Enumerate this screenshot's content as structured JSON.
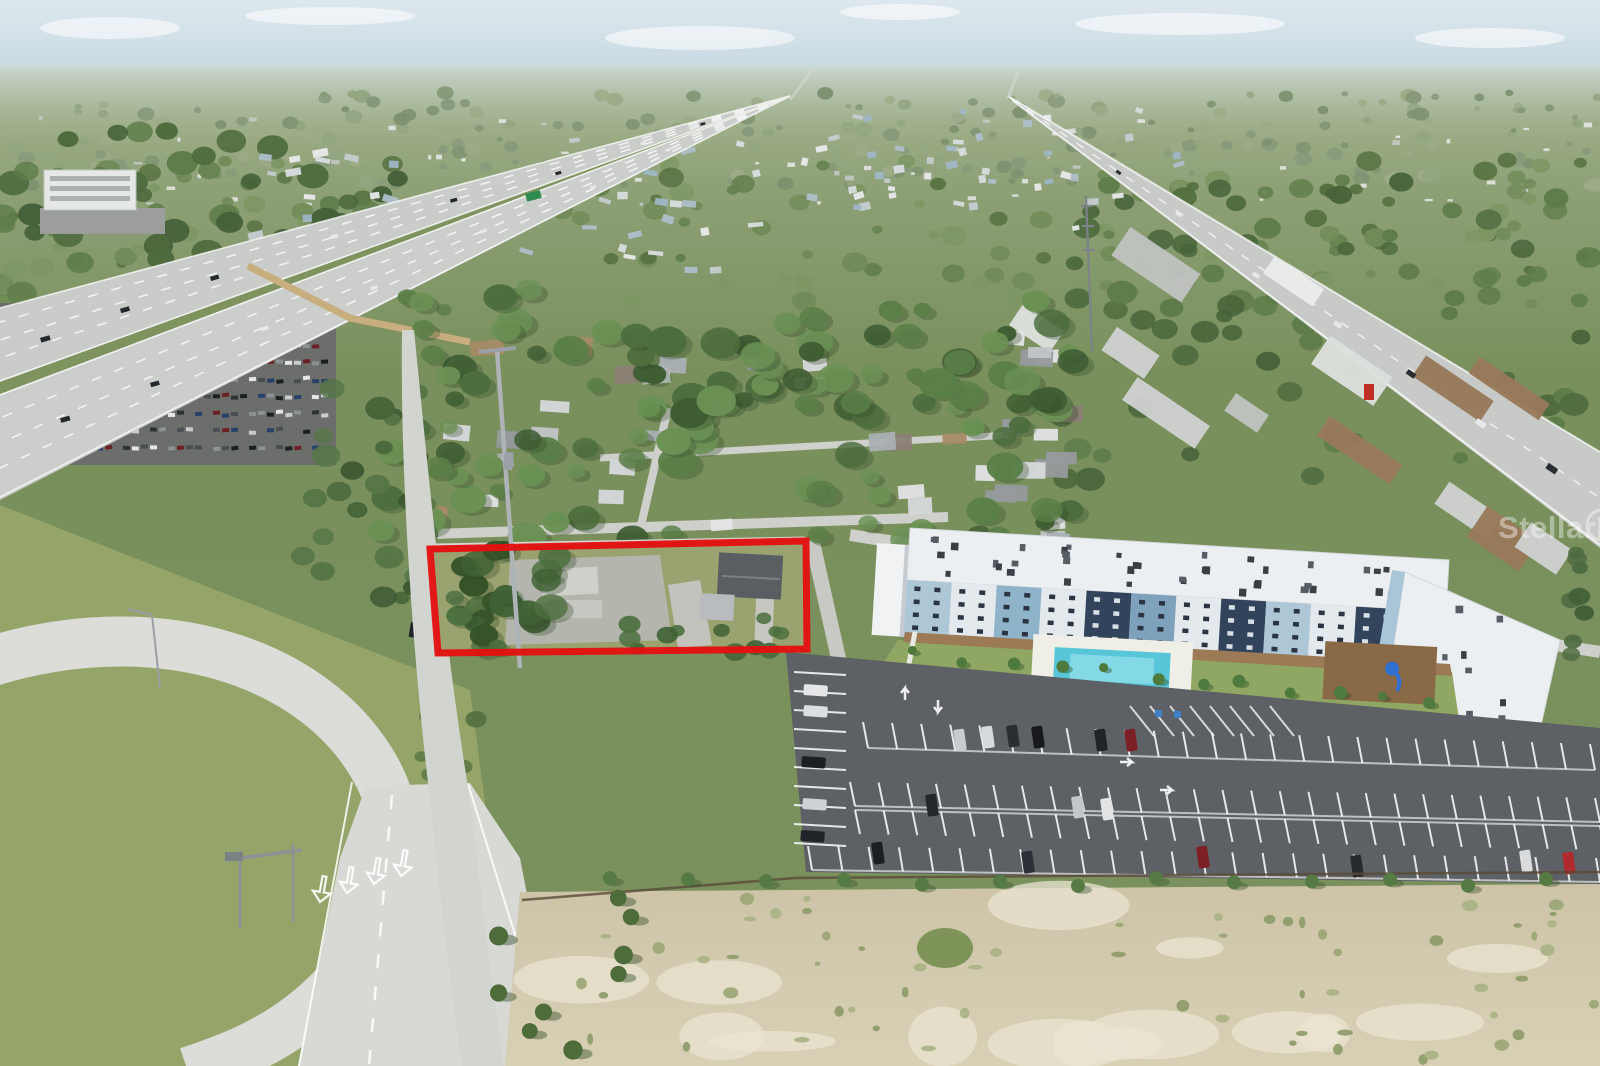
{
  "meta": {
    "alt": "Aerial drone photo of a vacant commercial parcel outlined in red, beside a highway interchange, residential neighborhood, commercial corridor and a new blue-and-white apartment complex with pool and parking lot, vacant sandy land in the foreground"
  },
  "watermark": {
    "text": "StellarMLS"
  },
  "annotation": {
    "label": "property-boundary",
    "color": "#e31212"
  },
  "palette": {
    "sky": "#ccdce4",
    "grass": "#7b915e",
    "trees": "#567243",
    "highway": "#cbcecb",
    "ramp_road": "#dcddd8",
    "asphalt": "#5d6064",
    "sand": "#d6cdb2",
    "pool": "#56c6d8",
    "building_roof": "#eceff1",
    "building_navy": "#32435c",
    "building_lightblue": "#aec7d6",
    "building_blue": "#7fa2bc",
    "sound_wall": "#c8ad7e",
    "mulch": "#8a6947",
    "slide_blue": "#2f6fd0",
    "red_car": "#7c2026"
  }
}
